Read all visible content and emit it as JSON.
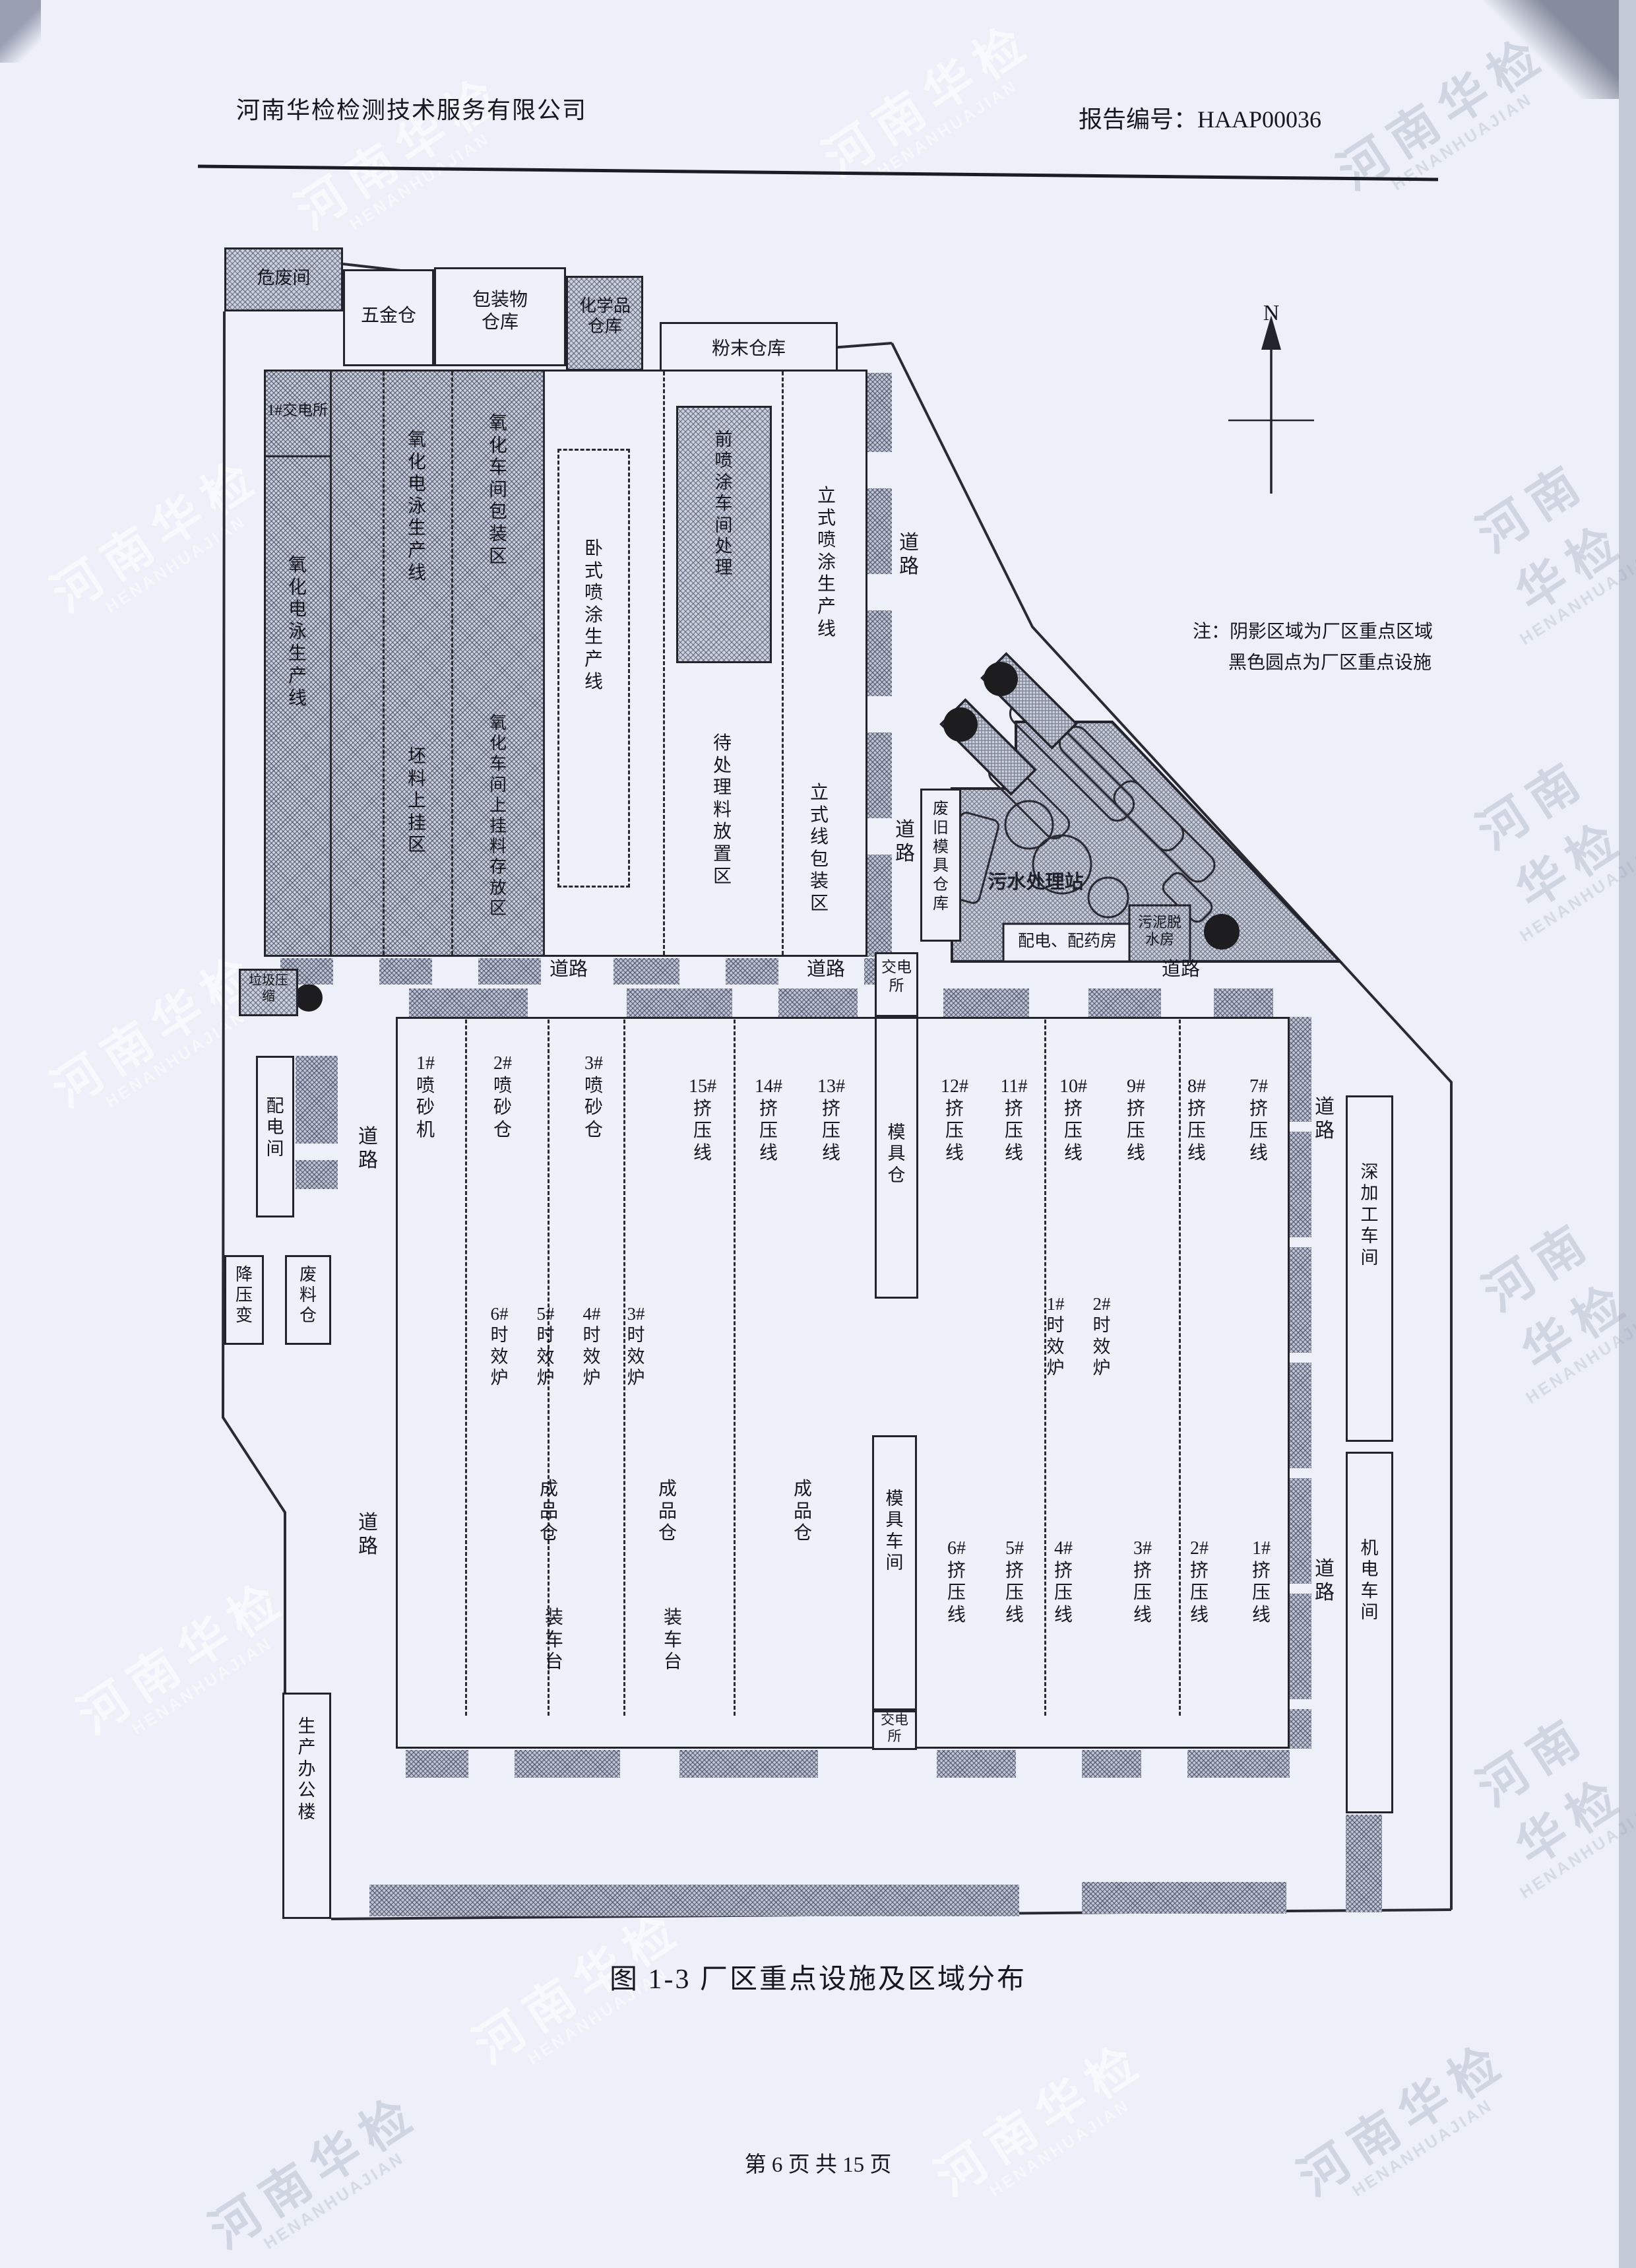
{
  "header": {
    "company": "河南华检检测技术服务有限公司",
    "report_no": "报告编号：HAAP00036"
  },
  "compass": {
    "north": "N"
  },
  "note": {
    "line1": "注：阴影区域为厂区重点区域",
    "line2": "黑色圆点为厂区重点设施"
  },
  "caption": "图 1-3  厂区重点设施及区域分布",
  "footer": {
    "page": "第 6 页 共 15 页"
  },
  "watermark": {
    "cn": "河南华检",
    "en": "HENANHUAJIAN"
  },
  "labels": {
    "weifeijian": "危废间",
    "wujincang": "五金仓",
    "baozhuangwu": "包装物\n仓库",
    "huaxuepin": "化学品\n仓库",
    "fenmocangku": "粉末仓库",
    "jiaodian1": "1#交电所",
    "yanghua_dianyong": "氧\n化\n电\n泳\n生\n产\n线",
    "pilao_shanggua": "坯\n料\n上\n挂\n区",
    "yanghua_baozhuang": "氧\n化\n车\n间\n包\n装\n区",
    "yanghua_cunfang": "氧\n化\n车\n间\n上\n挂\n料\n存\n放\n区",
    "woshi_pentu": "卧\n式\n喷\n涂\n生\n产\n线",
    "qian_pentu": "前\n喷\n涂\n车\n间\n处\n理",
    "daichuli": "待\n处\n理\n料\n放\n置\n区",
    "lishi_pentu": "立\n式\n喷\n涂\n生\n产\n线",
    "lishi_baozhuang": "立\n式\n线\n包\n装\n区",
    "daolu_v": "道\n路",
    "daolu_h": "道路",
    "feijiu_moju": "废\n旧\n模\n具\n仓\n库",
    "wushui": "污水处理站",
    "peidian_peiyao": "配电、配药房",
    "wuni_tuoshui": "污泥脱\n水房",
    "laji_yasuo": "垃圾压\n缩",
    "peidianjian": "配\n电\n间",
    "jiangyabian": "降\n压\n变",
    "feiliaocang": "废\n料\n仓",
    "bangonglou": "生\n产\n办\n公\n楼",
    "jiaodiansuo": "交电\n所",
    "mojucang": "模\n具\n仓",
    "mojuchejian": "模\n具\n车\n间",
    "p1": "1#\n喷\n砂\n机",
    "p2": "2#\n喷\n砂\n仓",
    "p3": "3#\n喷\n砂\n仓",
    "e1": "1#\n挤\n压\n线",
    "e2": "2#\n挤\n压\n线",
    "e3": "3#\n挤\n压\n线",
    "e4": "4#\n挤\n压\n线",
    "e5": "5#\n挤\n压\n线",
    "e6": "6#\n挤\n压\n线",
    "e7": "7#\n挤\n压\n线",
    "e8": "8#\n挤\n压\n线",
    "e9": "9#\n挤\n压\n线",
    "e10": "10#\n挤\n压\n线",
    "e11": "11#\n挤\n压\n线",
    "e12": "12#\n挤\n压\n线",
    "e13": "13#\n挤\n压\n线",
    "e14": "14#\n挤\n压\n线",
    "e15": "15#\n挤\n压\n线",
    "s1": "1#\n时\n效\n炉",
    "s2": "2#\n时\n效\n炉",
    "s3": "3#\n时\n效\n炉",
    "s4": "4#\n时\n效\n炉",
    "s5": "5#\n时\n效\n炉",
    "s6": "6#\n时\n效\n炉",
    "chengpincang": "成\n品\n仓",
    "zhuangchetai": "装\n车\n台",
    "shenjiagong": "深\n加\n工\n车\n间",
    "jidian": "机\n电\n车\n间"
  }
}
